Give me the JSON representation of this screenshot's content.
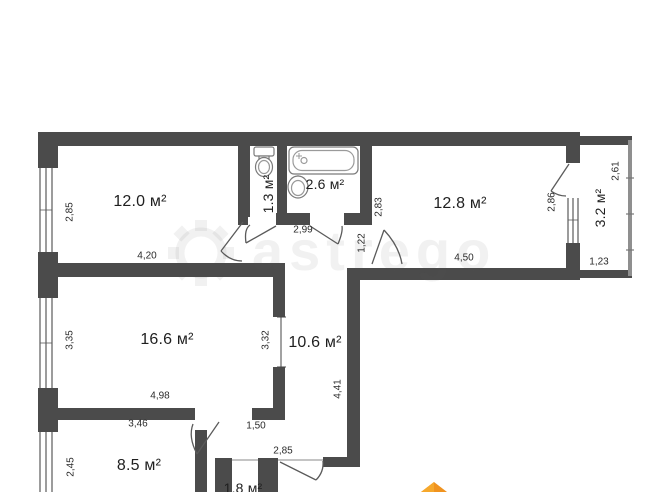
{
  "plan": {
    "title": "apartment-floor-plan",
    "watermark": "astrego",
    "colors": {
      "wall": "#4b4b4b",
      "thin_wall": "#8f8f8f",
      "logo_accent": "#f0931f"
    },
    "rooms": [
      {
        "name": "bedroom-1",
        "label": "12.0 м²"
      },
      {
        "name": "wc",
        "label": "1.3 м²"
      },
      {
        "name": "bathroom",
        "label": "2.6 м²"
      },
      {
        "name": "bedroom-2",
        "label": "12.8 м²"
      },
      {
        "name": "balcony",
        "label": "3.2 м²"
      },
      {
        "name": "living-room",
        "label": "16.6 м²"
      },
      {
        "name": "hallway",
        "label": "10.6 м²"
      },
      {
        "name": "kitchen",
        "label": "8.5 м²"
      },
      {
        "name": "storage",
        "label": "1.8 м²"
      }
    ],
    "dims": [
      {
        "text": "2,85"
      },
      {
        "text": "4,20"
      },
      {
        "text": "2,99"
      },
      {
        "text": "2,83"
      },
      {
        "text": "4,50"
      },
      {
        "text": "1,22"
      },
      {
        "text": "2,86"
      },
      {
        "text": "2,61"
      },
      {
        "text": "1,23"
      },
      {
        "text": "3,35"
      },
      {
        "text": "3,32"
      },
      {
        "text": "4,98"
      },
      {
        "text": "4,41"
      },
      {
        "text": "3,46"
      },
      {
        "text": "1,50"
      },
      {
        "text": "2,45"
      },
      {
        "text": "2,85"
      }
    ]
  }
}
